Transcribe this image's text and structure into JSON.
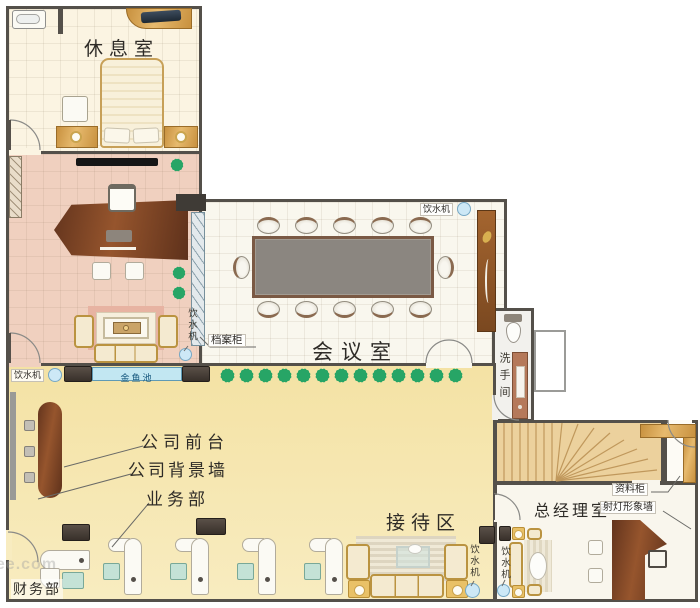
{
  "rooms": {
    "lounge": {
      "label": "休息室"
    },
    "executive_office": {},
    "meeting": {
      "label": "会议室",
      "file_cabinet_label": "档案柜"
    },
    "washroom": {
      "label": "洗手间"
    },
    "hall": {
      "pond_label": "金鱼池",
      "front_desk_label": "公司前台",
      "background_wall_label": "公司背景墙",
      "business_dept_label": "业务部",
      "reception_label": "接待区",
      "finance_dept_label": "财务部"
    },
    "gm_office": {
      "label": "总经理室",
      "file_cabinet_label": "资料柜",
      "feature_wall_label": "射灯形象墙"
    }
  },
  "shared": {
    "water_dispenser_label": "饮水机"
  },
  "watermark": {
    "text": "see.com"
  },
  "icons": {
    "plant": "green starburst",
    "water_dispenser": "small blue circle",
    "door": "quarter-arc swing",
    "stairs": "fanned winder treads"
  },
  "colors": {
    "wall": "#54504a",
    "hall_floor": "#f6e5ab",
    "executive_floor": "#f0d0bf",
    "plant_green": "#27a566",
    "pond_blue": "#c2e7f2",
    "wood": "#c8913f",
    "walnut_desk": "#7a4527",
    "conference_table": "#8b8680"
  }
}
